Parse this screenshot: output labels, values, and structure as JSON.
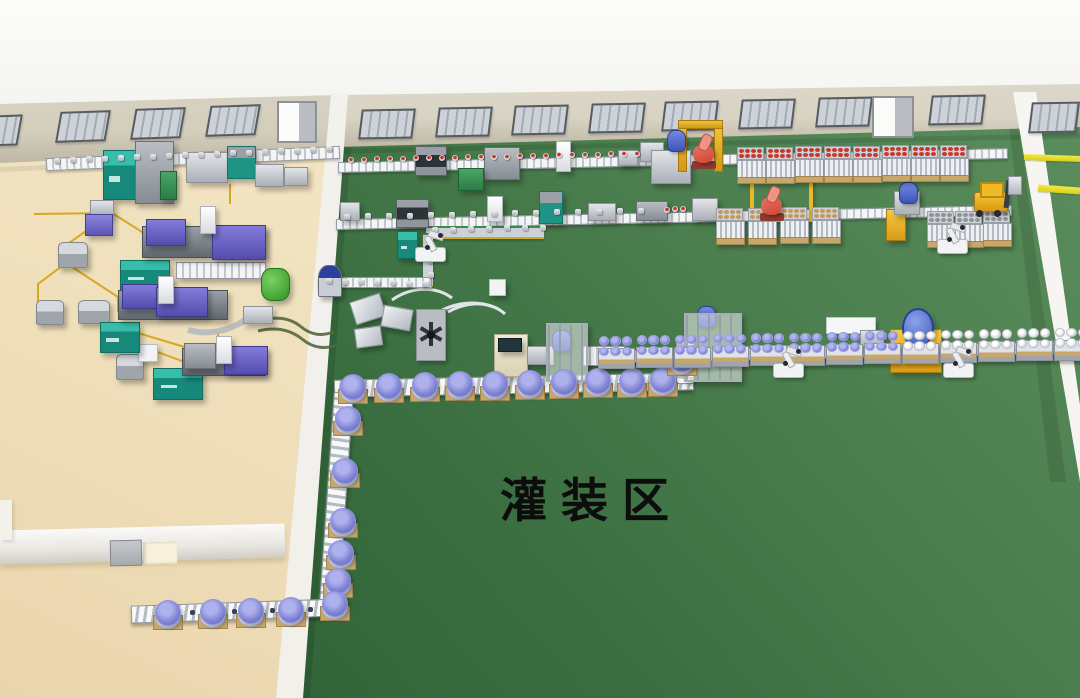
{
  "scene": {
    "area_label": "灌装区"
  },
  "palette": {
    "background": "#fbfbfa",
    "floor_green_light": "#5e905f",
    "floor_green_dark": "#2b5c32",
    "floor_beige_light": "#f7eed7",
    "floor_beige_dark": "#ead6ae",
    "wall_face_beige": "#d8d3c3",
    "wall_white": "#f3f1ec",
    "window_glass": "#c3c9cf",
    "lane_marking_yellow": "#e9de3a",
    "drum_lid_blue": "#7d82d2",
    "drum_lid_silver": "#d4d8df",
    "pallet_tan": "#c8a76a",
    "machine_teal": "#17897b",
    "machine_purple": "#6a63c6",
    "robot_red": "#df5848",
    "robot_white": "#f2f3f5",
    "forklift_yellow": "#f0b62a",
    "pipe_yellow": "#d8a722",
    "cap_red": "#c9372a"
  },
  "zones": {
    "molding_room": "molding-room-beige-floor",
    "filling_area": "filling-area-green-floor",
    "side_aisle": "aisle-with-yellow-lanes"
  }
}
